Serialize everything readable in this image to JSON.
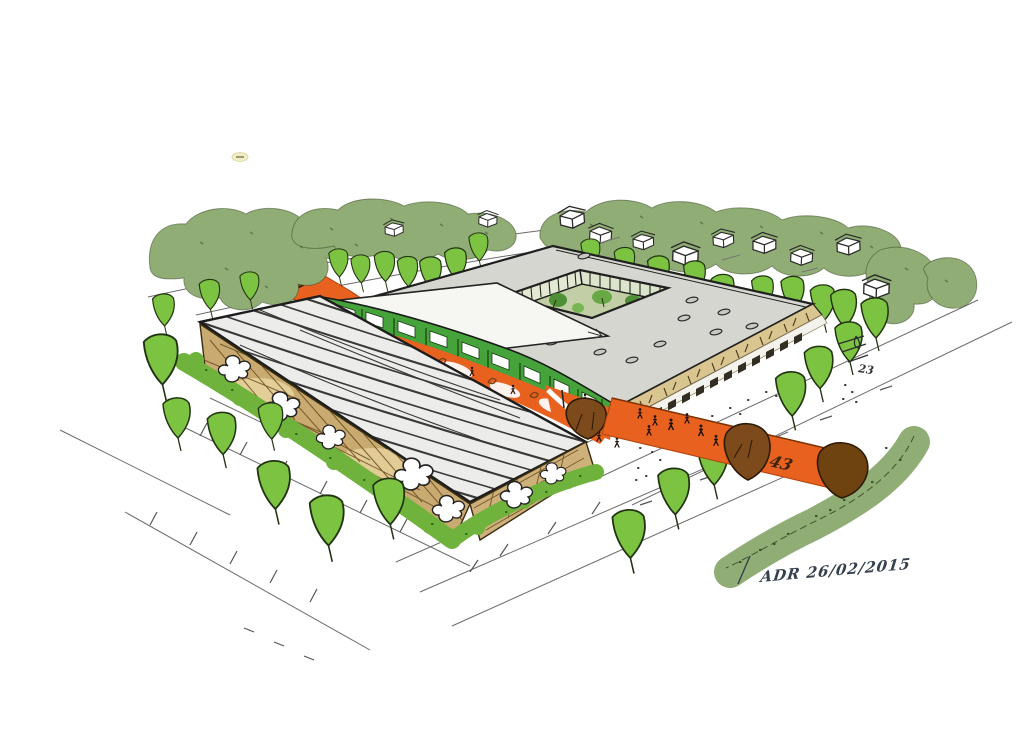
{
  "sketch": {
    "title": "aerial architectural concept sketch",
    "signature": "ADR 26/02/2015",
    "annotations": {
      "path_number": "43",
      "road_note": "23"
    },
    "palette": {
      "paper": "#ffffff",
      "ink": "#1f1f1f",
      "canopy_green": "#8fad74",
      "tree_green": "#7cc341",
      "hedge_green": "#6fb33c",
      "facade_green": "#46a33c",
      "courtyard_floor": "#c2cfa6",
      "orange_path": "#e8611f",
      "tree_brown": "#7d4b1b",
      "roof_gray": "#d6d6d1",
      "stripe_roof_gray": "#ececea",
      "roof_white": "#f6f6f2",
      "wall_tan": "#c9aa70",
      "fascia_tan": "#d9c58f",
      "signature_ink": "#35404d"
    }
  }
}
